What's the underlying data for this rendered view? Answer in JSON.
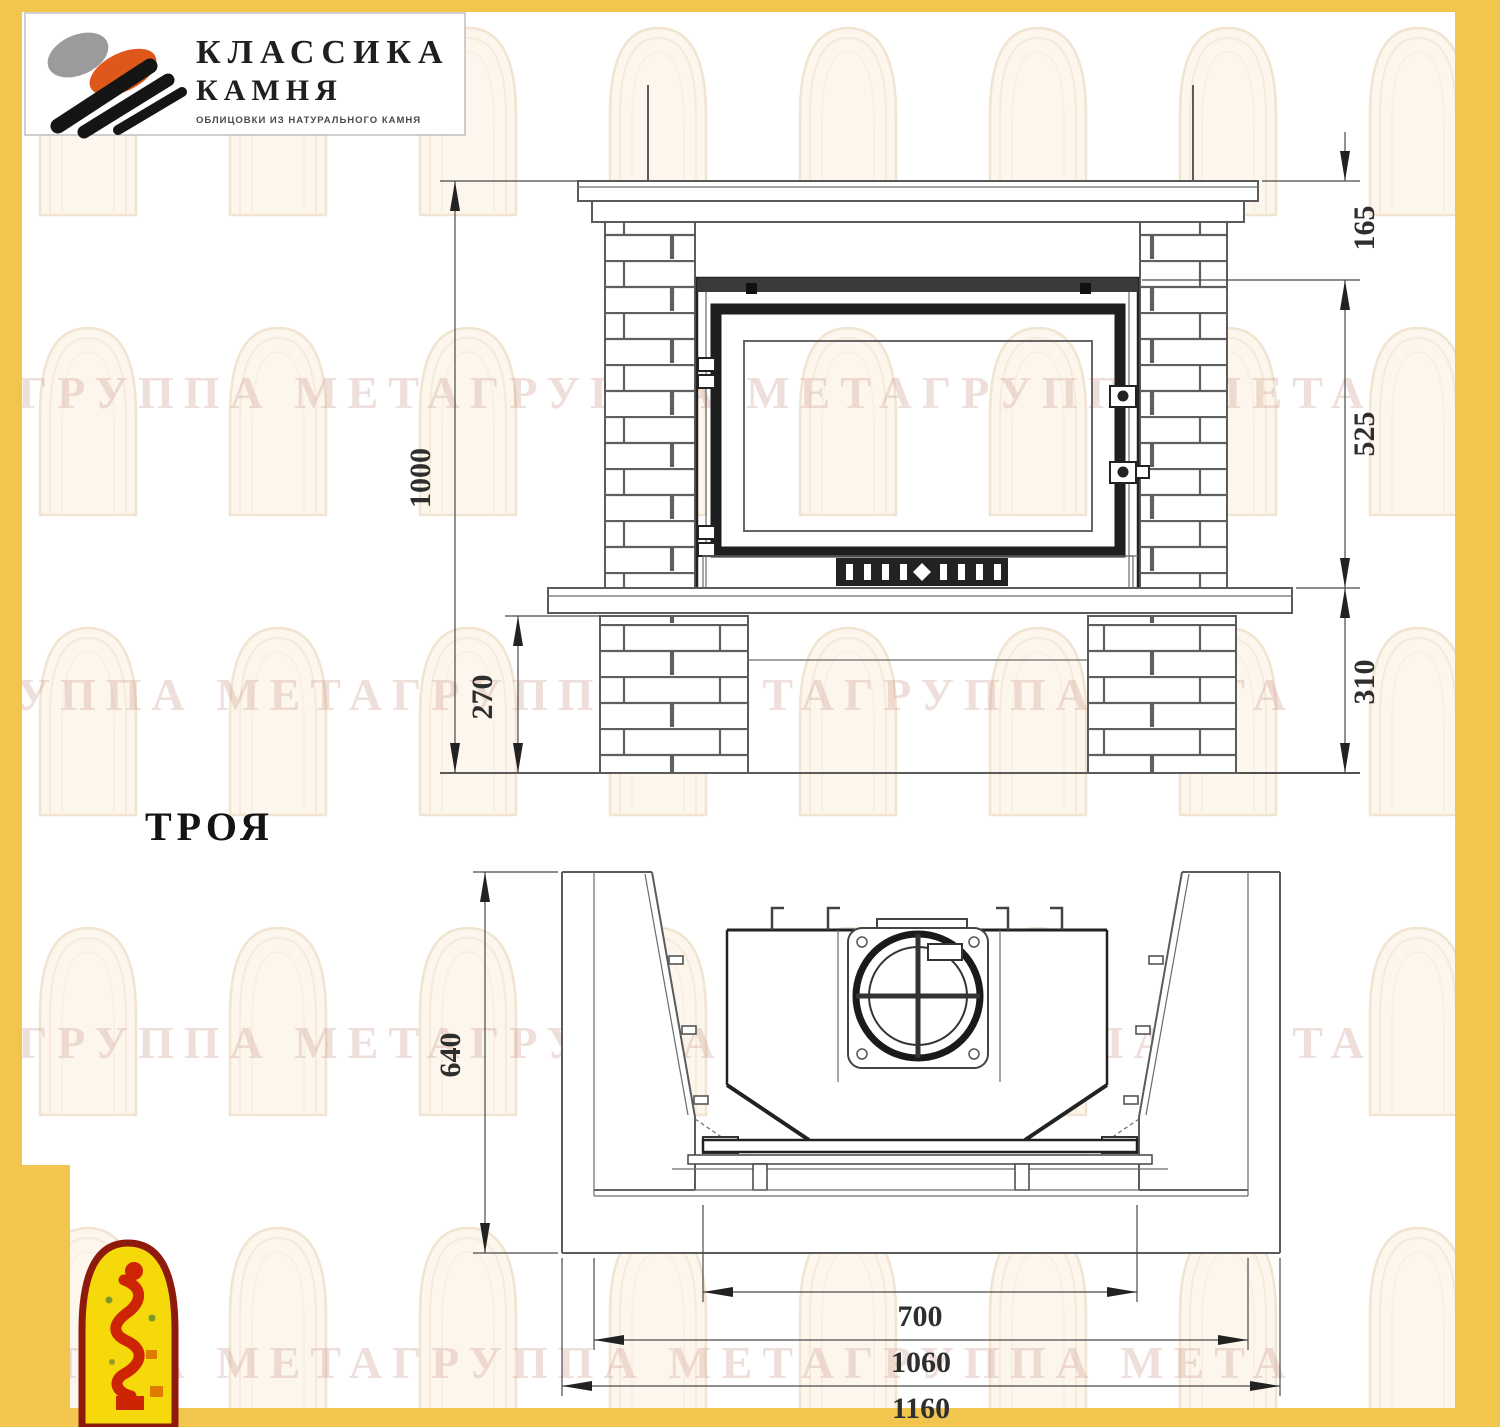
{
  "brand": {
    "line1": "КЛАССИКА",
    "line2": "КАМНЯ",
    "tagline": "ОБЛИЦОВКИ ИЗ НАТУРАЛЬНОГО КАМНЯ"
  },
  "model": {
    "name": "ТРОЯ"
  },
  "watermark": {
    "text": "ГРУППА МЕТАГРУППА МЕТАГРУППА МЕТА"
  },
  "front_view": {
    "dims": {
      "height_total": "1000",
      "mantel_to_insert": "165",
      "insert_height": "525",
      "bench_to_floor": "310",
      "plinth_height": "270"
    }
  },
  "plan_view": {
    "dims": {
      "depth": "640",
      "opening_width": "700",
      "body_width": "1060",
      "total_width": "1160"
    }
  },
  "colors": {
    "border_yellow": "#F2C54F",
    "line_gray": "#5b5b5b",
    "frame_dark": "#222222",
    "watermark_tint": "#c98f82",
    "logo_orange": "#E0571C",
    "logo_gray": "#9B9B9B",
    "firebird_yellow": "#F6D90A",
    "firebird_red": "#CC2405",
    "firebird_border": "#8D1A0B"
  }
}
